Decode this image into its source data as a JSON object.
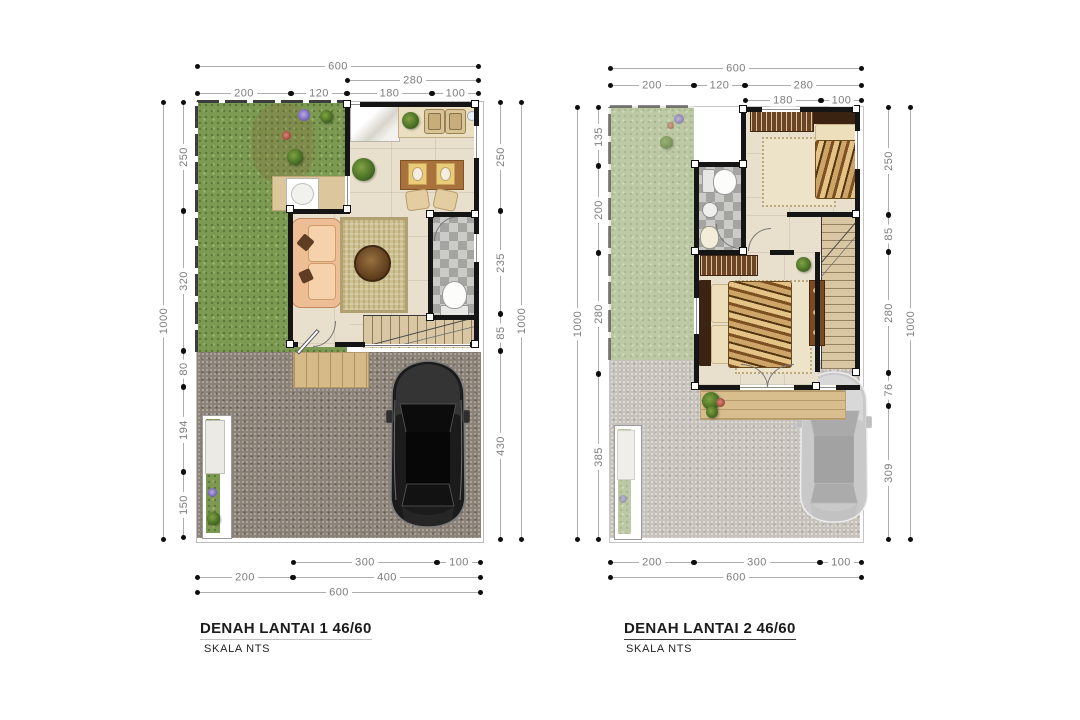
{
  "drawing": {
    "sheet_background": "#ffffff",
    "plans": [
      {
        "title": "DENAH LANTAI 1 46/60",
        "scale_label": "SKALA NTS",
        "dims": {
          "top": [
            "600",
            "280",
            "200",
            "120",
            "180",
            "100"
          ],
          "left": [
            "1000",
            "250",
            "320",
            "80",
            "194",
            "150"
          ],
          "right": [
            "250",
            "235",
            "85",
            "430",
            "1000"
          ],
          "bottom": [
            "300",
            "100",
            "200",
            "400",
            "600"
          ]
        }
      },
      {
        "title": "DENAH LANTAI 2 46/60",
        "scale_label": "SKALA NTS",
        "dims": {
          "top": [
            "600",
            "200",
            "120",
            "280",
            "180",
            "100"
          ],
          "left": [
            "1000",
            "135",
            "200",
            "280",
            "385"
          ],
          "right": [
            "250",
            "85",
            "280",
            "76",
            "309",
            "1000"
          ],
          "bottom": [
            "200",
            "300",
            "100",
            "600"
          ]
        }
      }
    ],
    "colors": {
      "grass": "#7d9a52",
      "grass_faded": "#bdc9a5",
      "gravel": "#8a8076",
      "gravel_faded": "#c6c2bb",
      "interior_floor": "#e8e0cd",
      "wall": "#151515",
      "deck_wood": "#d6ba87",
      "rug": "#cec08f",
      "sofa": "#edbd95",
      "dining_table": "#a9713b",
      "bathroom_tile": "#b7b7b4",
      "car_floor1": "#1b1b1b",
      "car_floor2": "#c9c9c9",
      "dimension_line": "#adadad",
      "dimension_text": "#7d7d7d",
      "title_text": "#1b1b1b"
    }
  }
}
